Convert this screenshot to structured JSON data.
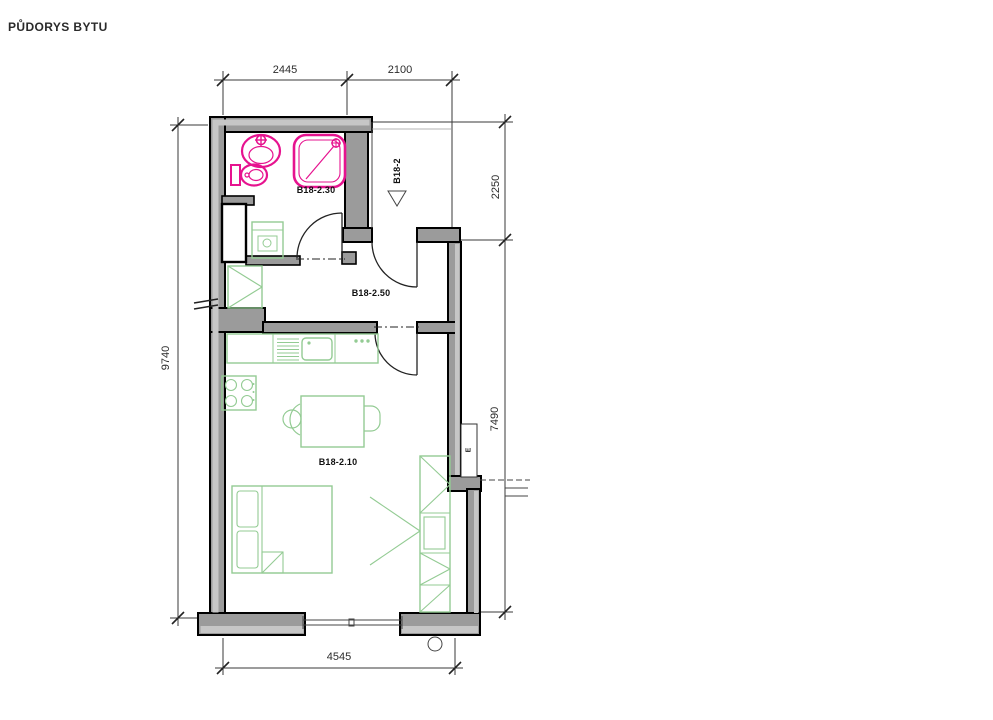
{
  "page_title": "PŮDORYS BYTU",
  "plan": {
    "rooms": {
      "bathroom": "B18-2.30",
      "hallway": "B18-2.50",
      "living_room": "B18-2.10",
      "entry_lobby": "B18-2"
    },
    "dimensions": {
      "top": [
        "2445",
        "2100"
      ],
      "right": [
        "2250",
        "7490"
      ],
      "left": [
        "9740"
      ],
      "bottom": [
        "4545"
      ]
    },
    "annotations": {
      "electric_meter": "E"
    },
    "symbols": [
      "entry-direction-triangle",
      "door-swing-arc",
      "wall-break-marks",
      "window",
      "circle-marker"
    ],
    "colors": {
      "wall_gray": "#9b9b9b",
      "wall_light": "#c6c6c6",
      "fixture_pink": "#e6138f",
      "furniture_green": "#93cb93",
      "line_dark": "#1b1b1b",
      "background": "#ffffff"
    }
  }
}
